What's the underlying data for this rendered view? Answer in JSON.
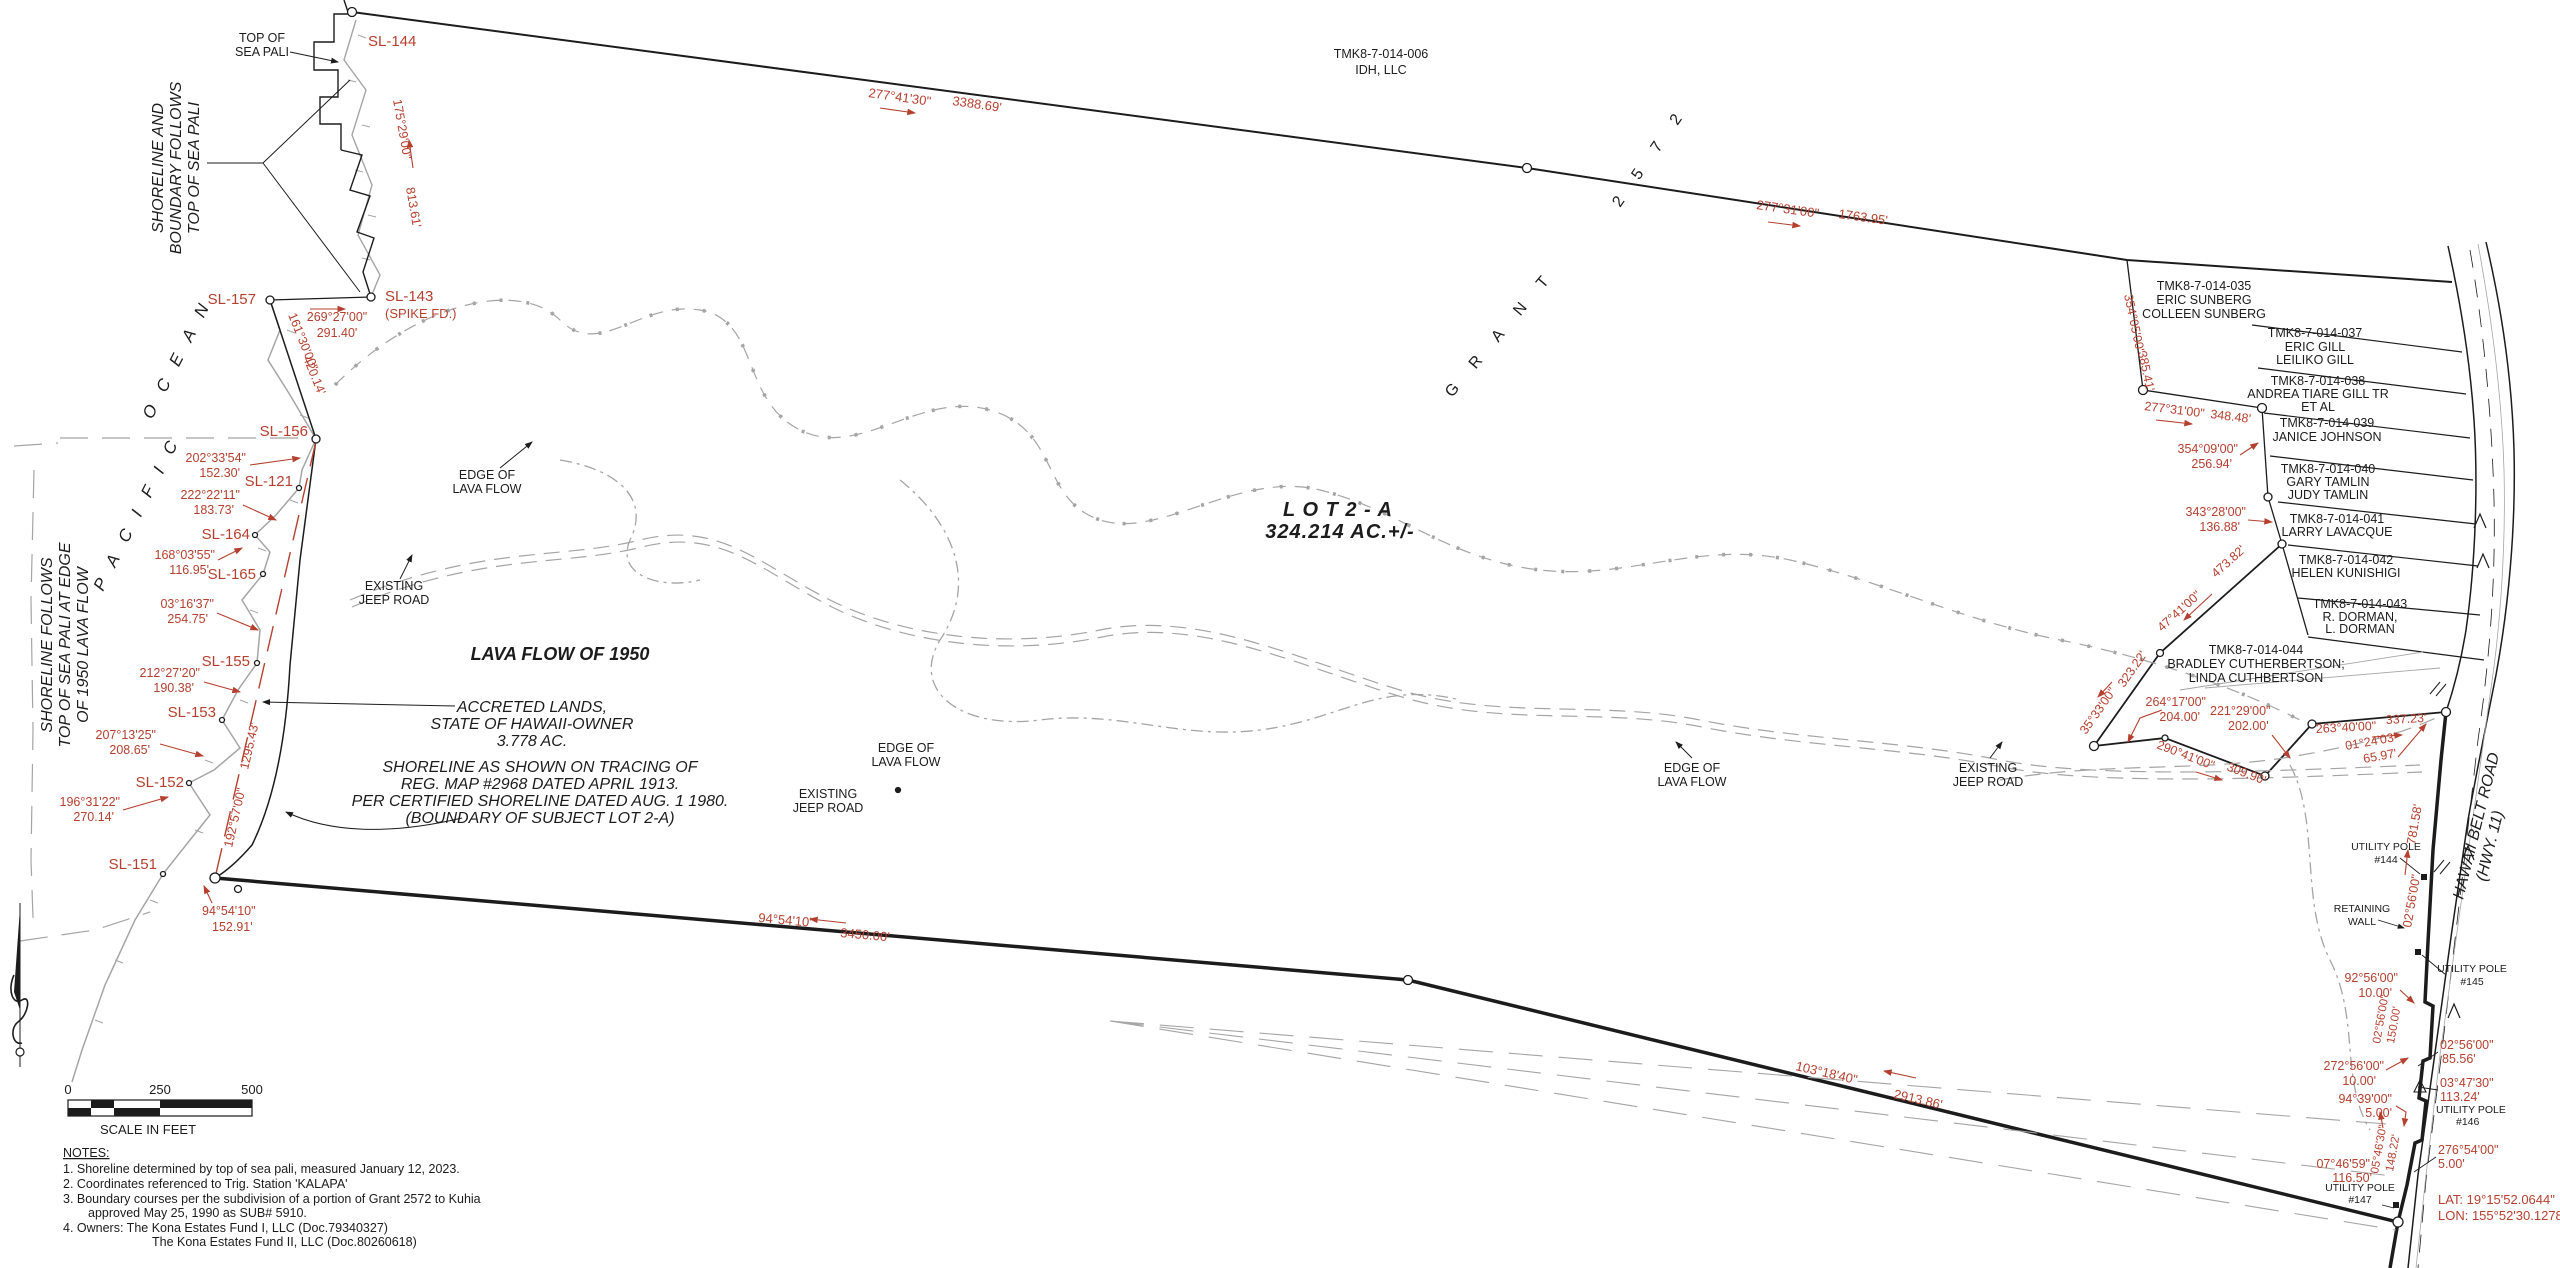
{
  "colors": {
    "red": "#b5402f",
    "ink": "#1c1c1c",
    "gray": "#9a9a9a"
  },
  "map": {
    "lot_name": "L O T    2   -   A",
    "lot_area": "324.214 AC.+/-",
    "grant_word": "G R A N T",
    "grant_number": "2 5 7 2"
  },
  "annotations": {
    "top_of_sea_pali": [
      "TOP OF",
      "SEA PALI"
    ],
    "shoreline_boundary": [
      "SHORELINE AND",
      "BOUNDARY FOLLOWS",
      "TOP OF SEA PALI"
    ],
    "shoreline_follows": [
      "SHORELINE FOLLOWS",
      "TOP OF SEA PALI AT EDGE",
      "OF 1950 LAVA FLOW"
    ],
    "ocean_word1": "P A C I F I C",
    "ocean_word2": "O C E A N",
    "lava_flow_1950": "LAVA FLOW OF 1950",
    "accreted": [
      "ACCRETED LANDS,",
      "STATE OF HAWAII-OWNER",
      "3.778 AC."
    ],
    "shoreline_note": [
      "SHORELINE AS SHOWN ON TRACING OF",
      "REG. MAP #2968 DATED APRIL 1913.",
      "PER CERTIFIED SHORELINE DATED AUG. 1 1980.",
      "(BOUNDARY OF SUBJECT LOT 2-A)"
    ],
    "edge_of_lava_flow": [
      "EDGE OF",
      "LAVA FLOW"
    ],
    "existing_jeep_road": [
      "EXISTING",
      "JEEP ROAD"
    ]
  },
  "survey_points": {
    "sl144": "SL-144",
    "sl157": "SL-157",
    "sl143": "SL-143",
    "sl143_note": "(SPIKE FD.)",
    "sl156": "SL-156",
    "sl121": "SL-121",
    "sl164": "SL-164",
    "sl165": "SL-165",
    "sl155": "SL-155",
    "sl153": "SL-153",
    "sl152": "SL-152",
    "sl151": "SL-151"
  },
  "bearings": {
    "b144": {
      "b": "175°29'00\"",
      "d": "813.61'"
    },
    "b143": {
      "b": "269°27'00\"",
      "d": "291.40'"
    },
    "b157": {
      "b": "161°30'00\"",
      "d": "420.14'"
    },
    "b156": {
      "b": "202°33'54\"",
      "d": "152.30'"
    },
    "b121": {
      "b": "222°22'11\"",
      "d": "183.73'"
    },
    "b164": {
      "b": "168°03'55\"",
      "d": "116.95'"
    },
    "b165": {
      "b": "03°16'37\"",
      "d": "254.75'"
    },
    "b155": {
      "b": "212°27'20\"",
      "d": "190.38'"
    },
    "b153": {
      "b": "207°13'25\"",
      "d": "208.65'"
    },
    "b152": {
      "b": "196°31'22\"",
      "d": "270.14'"
    },
    "b151": {
      "b": "94°54'10\"",
      "d": "152.91'"
    },
    "bdash": {
      "b": "192°57'00\"",
      "d": "1295.43'"
    },
    "btop1": {
      "b": "277°41'30\"",
      "d": "3388.69'"
    },
    "btop2": {
      "b": "277°31'00\"",
      "d": "1763.95'"
    },
    "b035w": {
      "b": "354°05'00\"",
      "d": "385.41'"
    },
    "b035s": {
      "b": "277°31'00\"",
      "d": "348.48'"
    },
    "b039w": {
      "b": "354°09'00\"",
      "d": "256.94'"
    },
    "b040w": {
      "b": "343°28'00\"",
      "d": "136.88'"
    },
    "bdiag": {
      "b": "47°41'00\"",
      "d": "473.82'"
    },
    "b3533": {
      "b": "35°33'00\"",
      "d": "323.22'"
    },
    "b264": {
      "b": "264°17'00\"",
      "d": "204.00'"
    },
    "b221": {
      "b": "221°29'00\"",
      "d": "202.00'"
    },
    "b290": {
      "b": "290°41'00\"",
      "d": "309.90'"
    },
    "b263": {
      "b": "263°40'00\"",
      "d": "337.23'"
    },
    "b0124": {
      "b": "01°24'03\"",
      "d": "65.97'"
    },
    "broad": {
      "b": "02°56'00\"",
      "d": "781.58'"
    },
    "b9256": {
      "b": "92°56'00\"",
      "d": "10.00'"
    },
    "b0256b": {
      "b": "02°56'00\"",
      "d": "150.00'"
    },
    "b272": {
      "b": "272°56'00\"",
      "d": "10.00'"
    },
    "b0256c": {
      "b": "02°56'00\"",
      "d": "85.56'"
    },
    "b0347": {
      "b": "03°47'30\"",
      "d": "113.24'"
    },
    "b9439": {
      "b": "94°39'00\"",
      "d": "5.00'"
    },
    "b0546": {
      "b": "05°46'30\"",
      "d": "148.22'"
    },
    "b276": {
      "b": "276°54'00\"",
      "d": "5.00'"
    },
    "b0746": {
      "b": "07°46'59\"",
      "d": "116.50'"
    },
    "bsouth1": {
      "b": "94°54'10\"",
      "d": "3450.00'"
    },
    "bsouth2": {
      "b": "103°18'40\"",
      "d": "2913.86'"
    }
  },
  "parcels": {
    "p006": {
      "tmk": "TMK8-7-014-006",
      "o1": "IDH, LLC"
    },
    "p035": {
      "tmk": "TMK8-7-014-035",
      "o1": "ERIC SUNBERG",
      "o2": "COLLEEN SUNBERG"
    },
    "p037": {
      "tmk": "TMK8-7-014-037",
      "o1": "ERIC GILL",
      "o2": "LEILIKO GILL"
    },
    "p038": {
      "tmk": "TMK8-7-014-038",
      "o1": "ANDREA TIARE GILL TR",
      "o2": "ET AL"
    },
    "p039": {
      "tmk": "TMK8-7-014-039",
      "o1": "JANICE JOHNSON"
    },
    "p040": {
      "tmk": "TMK8-7-014-040",
      "o1": "GARY TAMLIN",
      "o2": "JUDY TAMLIN"
    },
    "p041": {
      "tmk": "TMK8-7-014-041",
      "o1": "LARRY LAVACQUE"
    },
    "p042": {
      "tmk": "TMK8-7-014-042",
      "o1": "HELEN KUNISHIGI"
    },
    "p043": {
      "tmk": "TMK8-7-014-043",
      "o1": "R. DORMAN,",
      "o2": "L. DORMAN"
    },
    "p044": {
      "tmk": "TMK8-7-014-044",
      "o1": "BRADLEY CUTHERBERTSON;",
      "o2": "LINDA CUTHBERTSON"
    }
  },
  "road": {
    "name1": "HAWAII BELT ROAD",
    "name2": "(HWY. 11)",
    "pole_label": "UTILITY POLE",
    "pole144": "#144",
    "pole145": "#145",
    "pole146": "#146",
    "pole147": "#147",
    "retaining1": "RETAINING",
    "retaining2": "WALL"
  },
  "geo": {
    "lat": "LAT: 19°15'52.0644\"",
    "lon": "LON: 155°52'30.1278\""
  },
  "scale_bar": {
    "t0": "0",
    "t250": "250",
    "t500": "500",
    "caption": "SCALE IN FEET"
  },
  "notes": {
    "heading": "NOTES:",
    "n1": "1.  Shoreline determined by top of sea pali, measured January 12, 2023.",
    "n2": "2.  Coordinates referenced to Trig. Station 'KALAPA'",
    "n3a": "3.  Boundary courses per the subdivision of a portion of Grant 2572 to Kuhia",
    "n3b": "approved May 25, 1990 as SUB# 5910.",
    "n4a": "4.  Owners:        The Kona Estates Fund I, LLC (Doc.79340327)",
    "n4b": "The Kona Estates Fund II, LLC (Doc.80260618)"
  }
}
